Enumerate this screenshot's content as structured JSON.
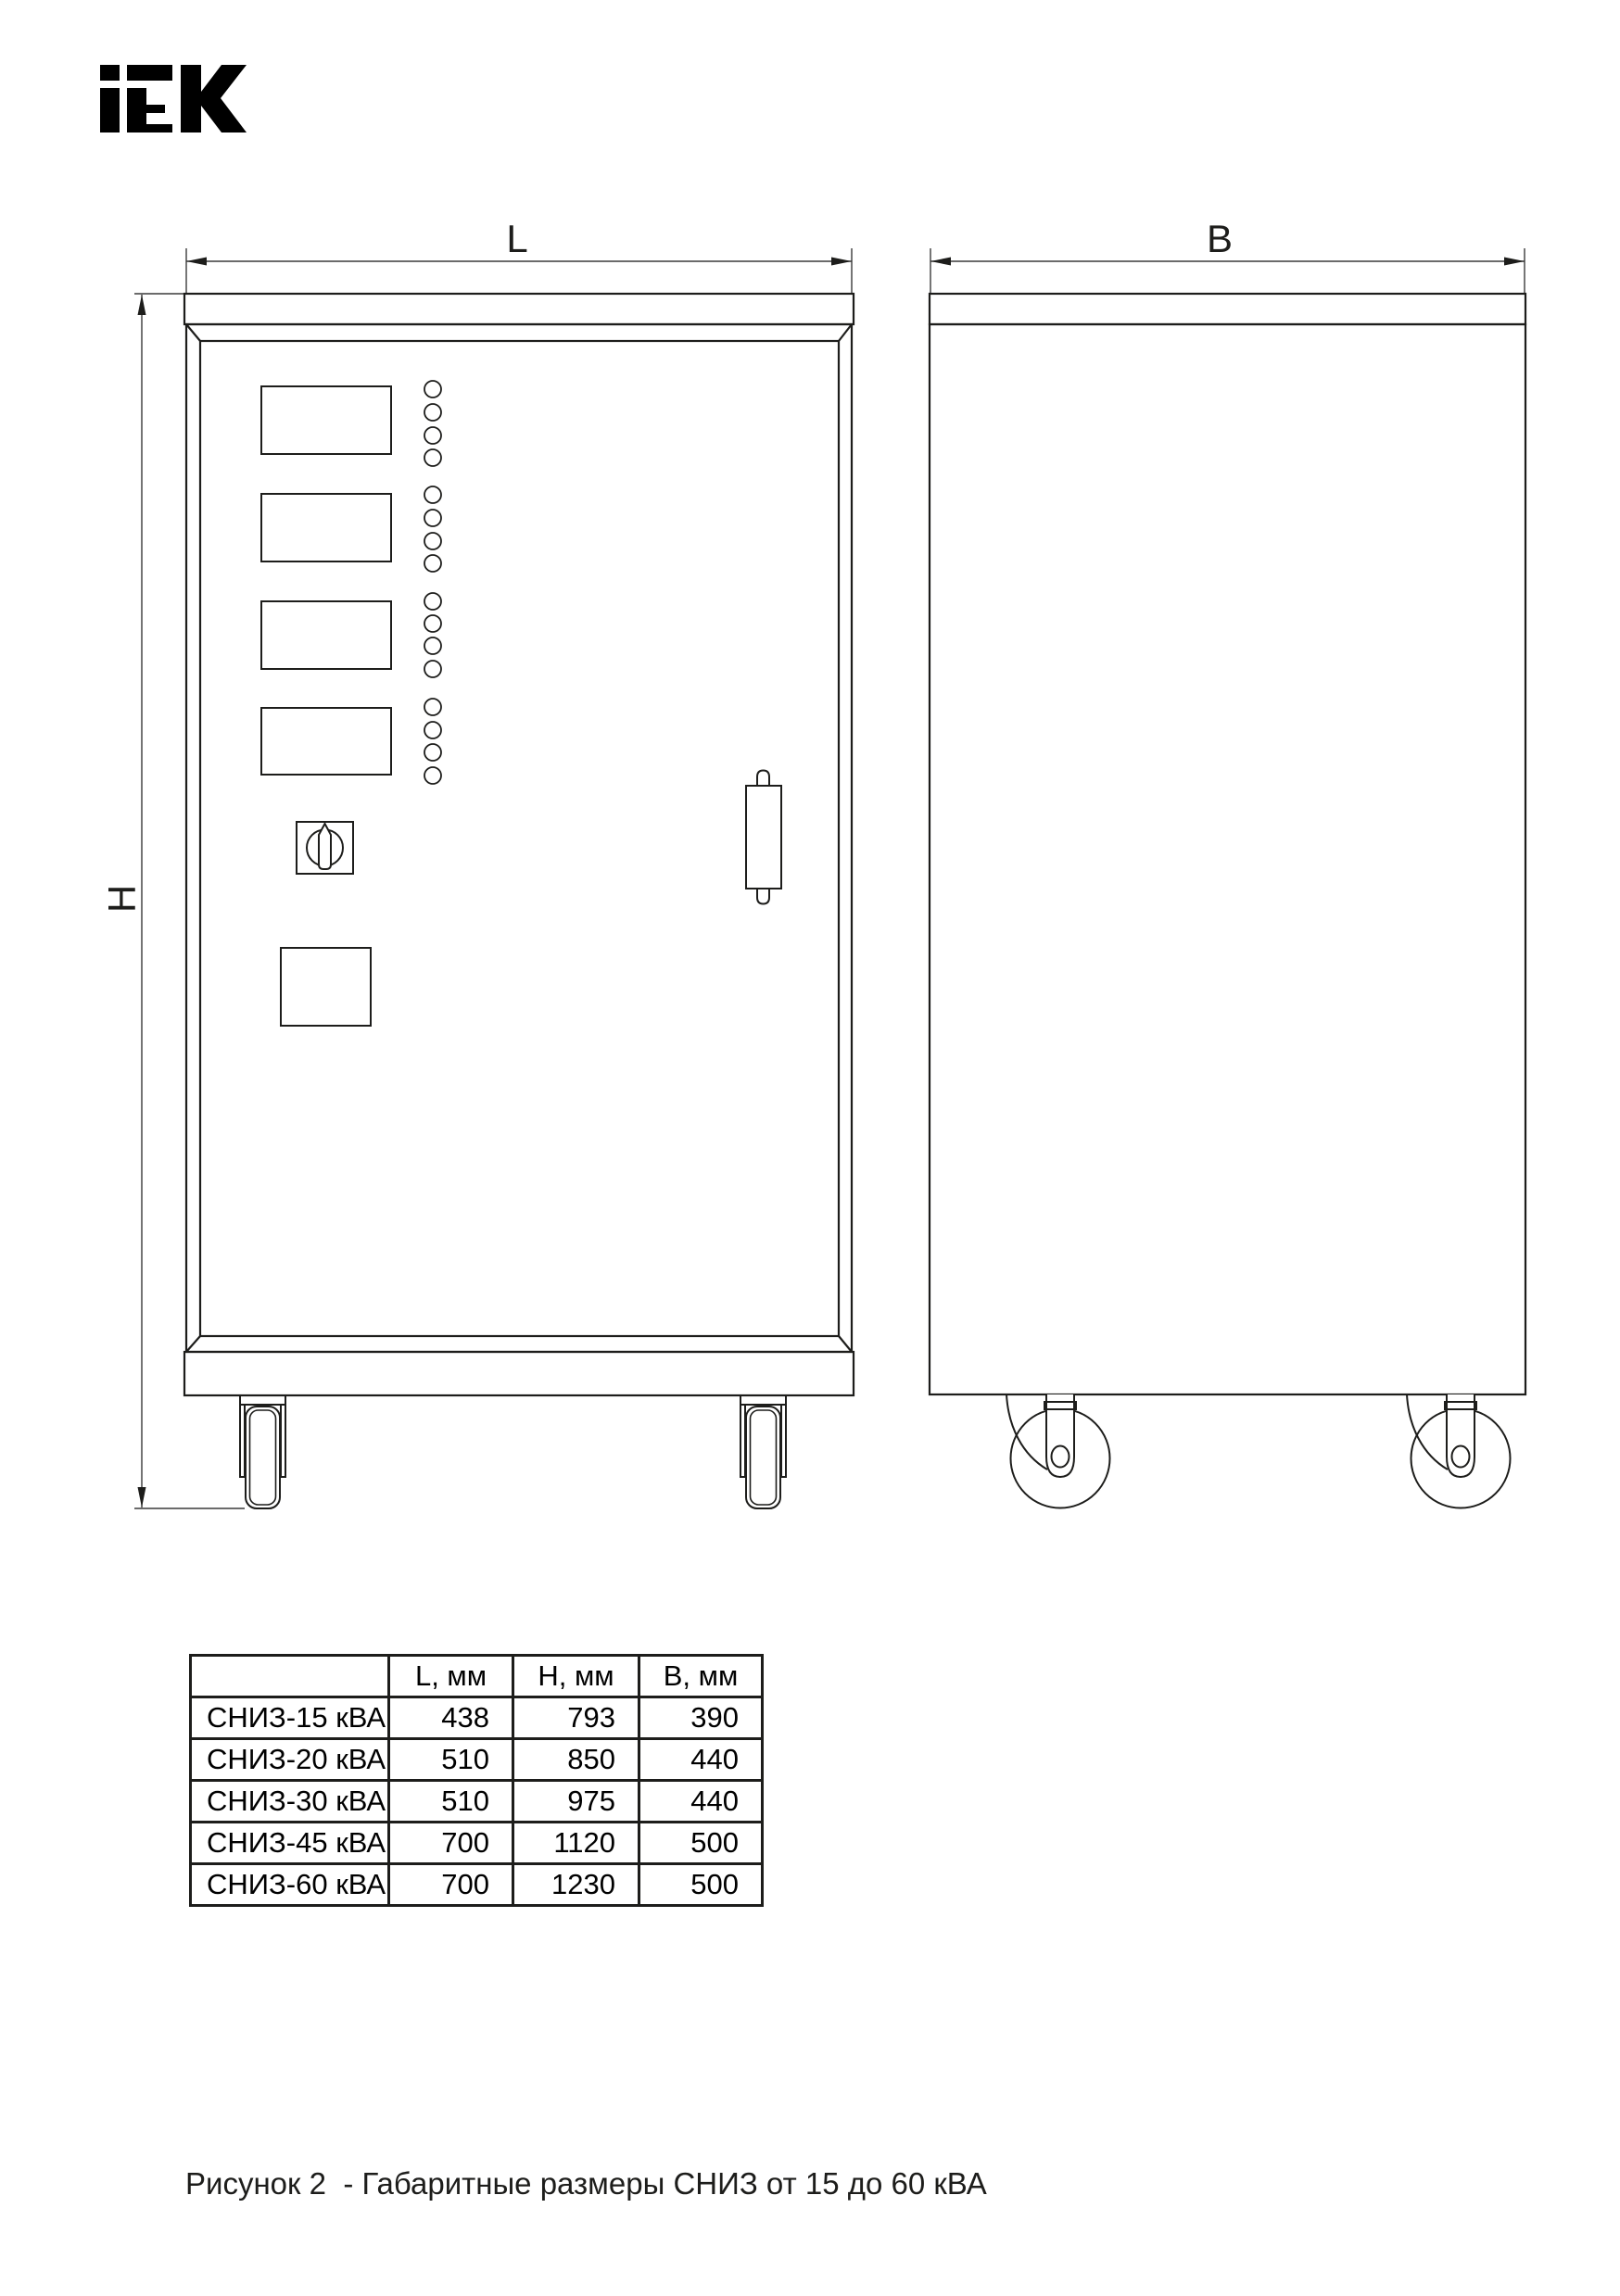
{
  "logo": {
    "brand": "IEK"
  },
  "drawing": {
    "length_label": "L",
    "width_label": "B",
    "height_label": "H"
  },
  "table": {
    "col_headers": [
      "L, мм",
      "H, мм",
      "B, мм"
    ],
    "rows": [
      {
        "model": "СНИЗ-15 кВА",
        "l": "438",
        "h": "793",
        "b": "390"
      },
      {
        "model": "СНИЗ-20 кВА",
        "l": "510",
        "h": "850",
        "b": "440"
      },
      {
        "model": "СНИЗ-30 кВА",
        "l": "510",
        "h": "975",
        "b": "440"
      },
      {
        "model": "СНИЗ-45 кВА",
        "l": "700",
        "h": "1120",
        "b": "500"
      },
      {
        "model": "СНИЗ-60 кВА",
        "l": "700",
        "h": "1230",
        "b": "500"
      }
    ]
  },
  "caption": "Рисунок 2  - Габаритные размеры СНИЗ от 15 до 60 кВА",
  "colors": {
    "line": "#1d1d1b",
    "background": "#ffffff"
  }
}
